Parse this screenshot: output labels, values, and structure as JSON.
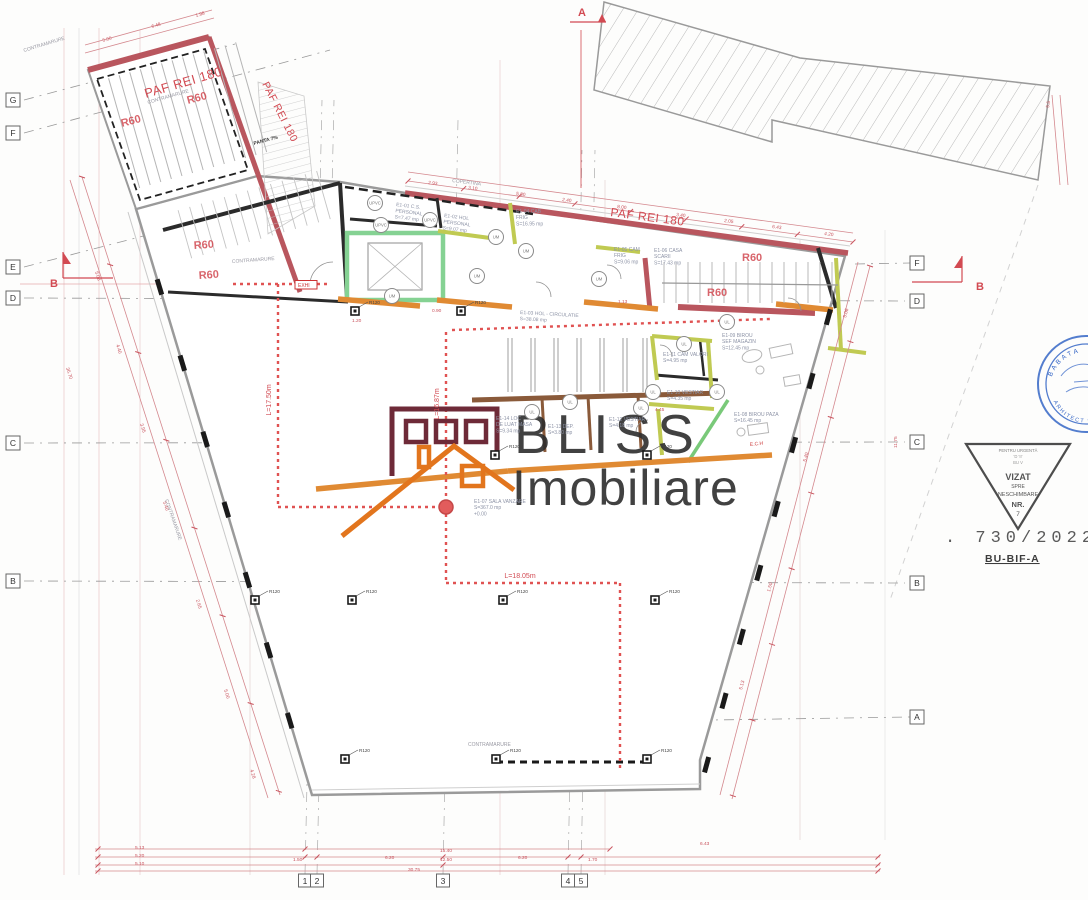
{
  "logo": {
    "line1": "BLISS",
    "line2": "Imobiliare"
  },
  "grid": {
    "left": [
      {
        "l": "G",
        "y": 100
      },
      {
        "l": "F",
        "y": 133
      },
      {
        "l": "E",
        "y": 267
      },
      {
        "l": "D",
        "y": 298
      },
      {
        "l": "C",
        "y": 443
      },
      {
        "l": "B",
        "y": 581
      }
    ],
    "right": [
      {
        "l": "F",
        "y": 263
      },
      {
        "l": "D",
        "y": 301
      },
      {
        "l": "C",
        "y": 442
      },
      {
        "l": "B",
        "y": 583
      },
      {
        "l": "A",
        "y": 717
      }
    ],
    "bottom": [
      {
        "l": "1",
        "x": 305
      },
      {
        "l": "2",
        "x": 317
      },
      {
        "l": "3",
        "x": 443
      },
      {
        "l": "4",
        "x": 568
      },
      {
        "l": "5",
        "x": 581
      }
    ]
  },
  "fire_labels": [
    {
      "t": "PAF REI 180",
      "x": 146,
      "y": 98,
      "r": -16.5,
      "s": 13
    },
    {
      "t": "PAF REI 180",
      "x": 262,
      "y": 84,
      "r": 63,
      "s": 10.5
    },
    {
      "t": "PAF REI 180",
      "x": 610,
      "y": 216,
      "r": 7.5,
      "s": 12
    }
  ],
  "r60_labels": [
    [
      122,
      127,
      -15
    ],
    [
      188,
      104,
      -15
    ],
    [
      194,
      249,
      -4
    ],
    [
      199,
      279,
      -4
    ],
    [
      742,
      261,
      0
    ],
    [
      707,
      296,
      0
    ]
  ],
  "rooms": [
    {
      "lines": [
        "E1-01 C.S.",
        "PERSONAL",
        "S=7.47 mp"
      ],
      "x": 396,
      "y": 206,
      "r": 7
    },
    {
      "lines": [
        "E1-02 HOL",
        "PERSONAL",
        "S=9.07 mp"
      ],
      "x": 444,
      "y": 217,
      "r": 7
    },
    {
      "lines": [
        "E1-04 CAB",
        "FRIG",
        "S=16.95 mp"
      ],
      "x": 516,
      "y": 213,
      "r": 0
    },
    {
      "lines": [
        "E1-05 CAM",
        "FRIG",
        "S=9.06 mp"
      ],
      "x": 614,
      "y": 251,
      "r": 0
    },
    {
      "lines": [
        "E1-06 CASA",
        "SCARII",
        "S=17.43 mp"
      ],
      "x": 654,
      "y": 252,
      "r": 0
    },
    {
      "lines": [
        "E1-03 HOL - CIRCULATIE",
        "S=38.08 mp"
      ],
      "x": 520,
      "y": 314,
      "r": 3
    },
    {
      "lines": [
        "E1-11 CAM VALORI",
        "S=4.95 mp"
      ],
      "x": 663,
      "y": 356,
      "r": 0
    },
    {
      "lines": [
        "E1-09 BIROU",
        "SEF MAGAZIN",
        "S=12.45 mp"
      ],
      "x": 722,
      "y": 337,
      "r": 0
    },
    {
      "lines": [
        "E1-10 VESTIAR",
        "S=4.35 mp"
      ],
      "x": 667,
      "y": 394,
      "r": 0
    },
    {
      "lines": [
        "E1-08 BIROU PAZA",
        "S=16.45 mp"
      ],
      "x": 734,
      "y": 416,
      "r": 0
    },
    {
      "lines": [
        "E1-14 LOC",
        "DE LUAT MASA",
        "S=9.34 mp"
      ],
      "x": 496,
      "y": 420,
      "r": 0
    },
    {
      "lines": [
        "E1-13 DEP.",
        "S=3.80 mp"
      ],
      "x": 548,
      "y": 428,
      "r": 0
    },
    {
      "lines": [
        "E1-12 VESTIAR",
        "S=4.18 mp"
      ],
      "x": 609,
      "y": 421,
      "r": 0
    },
    {
      "lines": [
        "E1-07 SALA VANZARE",
        "S=367.0 mp",
        "+0.00"
      ],
      "x": 474,
      "y": 503,
      "r": 0
    }
  ],
  "door_tags": [
    {
      "t": "UPVC",
      "x": 375,
      "y": 203
    },
    {
      "t": "UPVC",
      "x": 381,
      "y": 225
    },
    {
      "t": "UPVC",
      "x": 430,
      "y": 220
    },
    {
      "t": "UM",
      "x": 496,
      "y": 237
    },
    {
      "t": "UM",
      "x": 526,
      "y": 251
    },
    {
      "t": "UM",
      "x": 477,
      "y": 276
    },
    {
      "t": "UM",
      "x": 599,
      "y": 279
    },
    {
      "t": "UM",
      "x": 392,
      "y": 296
    },
    {
      "t": "UL",
      "x": 727,
      "y": 322
    },
    {
      "t": "UL",
      "x": 684,
      "y": 344
    },
    {
      "t": "UL",
      "x": 570,
      "y": 402
    },
    {
      "t": "UL",
      "x": 532,
      "y": 412
    },
    {
      "t": "UL",
      "x": 641,
      "y": 408
    },
    {
      "t": "UL",
      "x": 653,
      "y": 392
    },
    {
      "t": "UL",
      "x": 717,
      "y": 392
    }
  ],
  "r120_label": "R120",
  "r120_markers": [
    [
      355,
      311
    ],
    [
      461,
      311
    ],
    [
      495,
      455
    ],
    [
      647,
      455
    ],
    [
      255,
      600
    ],
    [
      352,
      600
    ],
    [
      503,
      600
    ],
    [
      655,
      600
    ],
    [
      345,
      759
    ],
    [
      496,
      759
    ],
    [
      647,
      759
    ]
  ],
  "evac_labels": [
    {
      "t": "L=17.50m",
      "x": 271,
      "y": 400,
      "r": -90
    },
    {
      "t": "L=16.87m",
      "x": 439,
      "y": 404,
      "r": -90
    },
    {
      "t": "L=18.05m",
      "x": 520,
      "y": 578,
      "r": 0
    }
  ],
  "annotations": [
    {
      "text": "CONTRAMARURE",
      "x": 24,
      "y": 52,
      "r": -17
    },
    {
      "text": "CONTRAMARURE",
      "x": 148,
      "y": 104,
      "r": -16
    },
    {
      "text": "CONTRAMARURE",
      "x": 232,
      "y": 263,
      "r": -4
    },
    {
      "text": "CONTRAMARURE",
      "x": 165,
      "y": 500,
      "r": 71
    },
    {
      "text": "CONTRAMARURE",
      "x": 468,
      "y": 746,
      "r": 0
    },
    {
      "text": "COPERTINA",
      "x": 452,
      "y": 182,
      "r": 7
    },
    {
      "text": "PANTA 7%",
      "x": 254,
      "y": 145,
      "r": -15,
      "dark": true
    },
    {
      "text": "E.C.H",
      "x": 750,
      "y": 446,
      "r": -6,
      "red": true
    },
    {
      "text": "EXHI",
      "x": 298,
      "y": 287,
      "r": 0,
      "red": true,
      "box": true
    }
  ],
  "section_markers": [
    {
      "label": "A",
      "x": 578,
      "y": 16,
      "dir": "top"
    },
    {
      "label": "B",
      "x": 50,
      "y": 287,
      "dir": "left"
    },
    {
      "label": "B",
      "x": 976,
      "y": 290,
      "dir": "right"
    }
  ],
  "dims": [
    {
      "t": "5.13",
      "x": 135,
      "y": 849,
      "r": 0
    },
    {
      "t": "5.20",
      "x": 135,
      "y": 857,
      "r": 0
    },
    {
      "t": "5.10",
      "x": 135,
      "y": 865,
      "r": 0
    },
    {
      "t": "1.50",
      "x": 293,
      "y": 861,
      "r": 0
    },
    {
      "t": "6.20",
      "x": 385,
      "y": 859,
      "r": 0
    },
    {
      "t": "15.40",
      "x": 440,
      "y": 852,
      "r": 0
    },
    {
      "t": "12.50",
      "x": 440,
      "y": 861,
      "r": 0
    },
    {
      "t": "6.20",
      "x": 518,
      "y": 859,
      "r": 0
    },
    {
      "t": "1.70",
      "x": 588,
      "y": 861,
      "r": 0
    },
    {
      "t": "30.75",
      "x": 408,
      "y": 871,
      "r": 0
    },
    {
      "t": "6.43",
      "x": 700,
      "y": 845,
      "r": 0
    },
    {
      "t": "2.93",
      "x": 428,
      "y": 184,
      "r": 8
    },
    {
      "t": "3.10",
      "x": 468,
      "y": 189,
      "r": 8
    },
    {
      "t": "5.80",
      "x": 516,
      "y": 195,
      "r": 8
    },
    {
      "t": "2.40",
      "x": 562,
      "y": 201,
      "r": 8
    },
    {
      "t": "8.00",
      "x": 617,
      "y": 208,
      "r": 8
    },
    {
      "t": "3.40",
      "x": 676,
      "y": 216,
      "r": 8
    },
    {
      "t": "2.05",
      "x": 724,
      "y": 222,
      "r": 8
    },
    {
      "t": "6.43",
      "x": 772,
      "y": 228,
      "r": 8
    },
    {
      "t": "4.20",
      "x": 824,
      "y": 235,
      "r": 8
    },
    {
      "t": "5.00",
      "x": 103,
      "y": 42,
      "r": -16
    },
    {
      "t": "6.48",
      "x": 152,
      "y": 28,
      "r": -16
    },
    {
      "t": "1.98",
      "x": 196,
      "y": 17,
      "r": -16
    },
    {
      "t": "5.08",
      "x": 95,
      "y": 272,
      "r": 72
    },
    {
      "t": "4.40",
      "x": 116,
      "y": 345,
      "r": 72
    },
    {
      "t": "3.95",
      "x": 140,
      "y": 424,
      "r": 72
    },
    {
      "t": "36.70",
      "x": 66,
      "y": 368,
      "r": 72
    },
    {
      "t": "5.40",
      "x": 163,
      "y": 502,
      "r": 72
    },
    {
      "t": "2.65",
      "x": 196,
      "y": 600,
      "r": 72
    },
    {
      "t": "5.00",
      "x": 224,
      "y": 690,
      "r": 72
    },
    {
      "t": "4.28",
      "x": 250,
      "y": 770,
      "r": 72
    },
    {
      "t": "5.08",
      "x": 846,
      "y": 318,
      "r": -75
    },
    {
      "t": "11.75",
      "x": 897,
      "y": 448,
      "r": -90
    },
    {
      "t": "5.40",
      "x": 806,
      "y": 462,
      "r": -75
    },
    {
      "t": "1.50",
      "x": 770,
      "y": 592,
      "r": -75
    },
    {
      "t": "5.13",
      "x": 742,
      "y": 690,
      "r": -75
    },
    {
      "t": "5.5",
      "x": 1049,
      "y": 108,
      "r": -80
    },
    {
      "t": "4.45",
      "x": 655,
      "y": 411,
      "r": 0
    },
    {
      "t": "1.13",
      "x": 618,
      "y": 303,
      "r": 0
    },
    {
      "t": "1.20",
      "x": 352,
      "y": 322,
      "r": 0
    },
    {
      "t": "0.90",
      "x": 432,
      "y": 312,
      "r": 0
    }
  ],
  "stamps": {
    "round": {
      "arc_top": "BABATA",
      "arc_bottom": "ARHITECT DIPL.",
      "color": "#3566c6"
    },
    "triangle": {
      "tiny1": "PENTRU      URGENTĂ",
      "tiny2": "'D            'II'",
      "tiny3": "BU            V",
      "l1": "VIZAT",
      "l2": "SPRE",
      "l3": "NESCHIMBARE",
      "l4": "NR.",
      "l5": "7"
    },
    "number": ". 730/2022 .",
    "code": "BU-BIF-A"
  },
  "colors": {
    "fire_wall": "#b9565e",
    "dim_red": "#cc5560",
    "green_wall": "#85d293",
    "olive_wall": "#c0ca52",
    "orange_wall": "#e08a33",
    "brown_wall": "#8a5a3a",
    "logo_maroon": "#6e2a38",
    "logo_orange": "#e2751d",
    "stamp_blue": "#3566c6"
  }
}
